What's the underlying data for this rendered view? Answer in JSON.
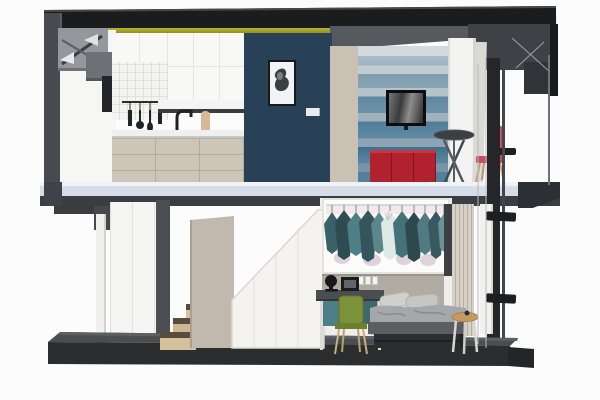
{
  "meta": {
    "kind": "3d-sectional-render",
    "subject": "two-story micro loft apartment shown as a cutaway dollhouse section",
    "render_style": "sketchup-like architectural render, no visible text",
    "background": "#fcfcfc"
  },
  "palette": {
    "roof_black": "#1b1c1e",
    "frame_gray": "#474b50",
    "led_strip_olive": "#8f9023",
    "navy_accent_wall": "#294156",
    "tile_white": "#f3f3f1",
    "cabinet_white": "#f8f8f6",
    "cabinet_wood": "#ccc5b8",
    "mural_blue_mid": "#7e9dae",
    "tv_black": "#0c0d0e",
    "console_red": "#b1212e",
    "slab_light": "#d6dde8",
    "slab_fascia": "#3a3e43",
    "floor_plate_dark": "#2b2d2f",
    "stair_wood": "#d5c19b",
    "storage_greige": "#c1b9ae",
    "wardrobe_white": "#f4f3f0",
    "closet_teal": "#4f7f86",
    "bed_charcoal": "#2c2e31",
    "chair_green": "#7d9138",
    "chair_pink": "#d15a6e",
    "side_table_wood": "#c59a5f"
  },
  "upper_floor": {
    "rooms": [
      {
        "name": "kitchen",
        "items": [
          "white upper cabinets",
          "white tile backsplash",
          "hanging black utensils on rail",
          "open shelf with dark underside",
          "black gooseneck faucet",
          "beige vase",
          "white countertop",
          "light wood base cabinets with drawers"
        ]
      },
      {
        "name": "hall",
        "items": [
          "navy accent wall",
          "framed abstract artwork",
          "white double light switch"
        ]
      },
      {
        "name": "living-room",
        "items": [
          "gray sloped ceiling",
          "wood side panel",
          "blue watercolor mural wall",
          "wall mounted tv",
          "red media console on legs",
          "round bistro table with crossed legs",
          "white partition panel"
        ]
      },
      {
        "name": "balcony",
        "items": [
          "dark roof box with cable braces",
          "pink chair",
          "black steel post",
          "tension cables"
        ]
      }
    ]
  },
  "lower_floor": {
    "rooms": [
      {
        "name": "stairwell",
        "items": [
          "steel bracket under slab",
          "white support column",
          "white paneled wall",
          "dark steel column",
          "wood steps with dark treads",
          "tall greige storage volume",
          "sloped white wardrobe panel"
        ]
      },
      {
        "name": "bedroom",
        "items": [
          "open closet with teal hanging clothes and one light garment",
          "greige headboard wall",
          "power outlets",
          "desk with black lamp and photo frame",
          "green desk chair",
          "platform bed with gray pillows and charcoal duvet",
          "round wood side table",
          "vertical wood slat wall",
          "black ladder post with two rungs",
          "tension cables"
        ]
      }
    ]
  },
  "structure": {
    "elements": [
      "black roof band",
      "olive led cove strip",
      "diagonal brace gussets at top left",
      "light mid floor slab with dark fascia",
      "dark base plate with beveled front",
      "right side overhang"
    ]
  }
}
